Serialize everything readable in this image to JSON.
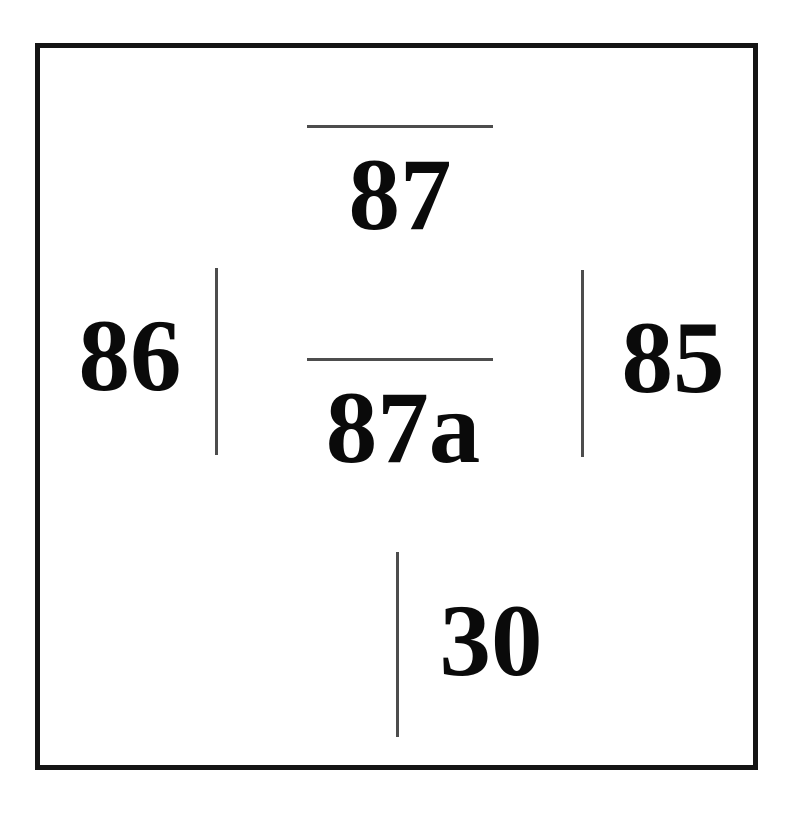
{
  "diagram": {
    "kind": "automotive-relay-pinout",
    "pins": {
      "top": {
        "label": "87"
      },
      "center": {
        "label": "87a"
      },
      "left": {
        "label": "86"
      },
      "right": {
        "label": "85"
      },
      "bottom": {
        "label": "30"
      }
    },
    "colors": {
      "background": "#ffffff",
      "outline": "#141414",
      "terminal_line": "#4d4d4d",
      "text": "#0a0a0a"
    }
  }
}
